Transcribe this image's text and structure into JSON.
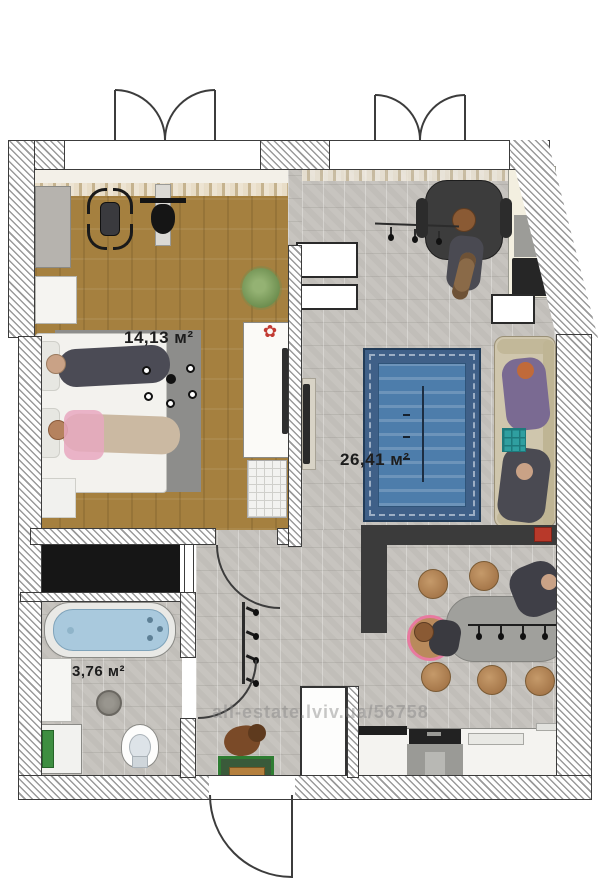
{
  "plan": {
    "type": "apartment-floor-plan",
    "labels": {
      "bedroom_area": "14,13 м²",
      "living_area": "26,41 м²",
      "bathroom_area": "3,76 м²"
    },
    "watermark": "all-estate.lviv.ua/56758",
    "rooms": [
      {
        "name": "bedroom-gym",
        "area": "14,13 м²",
        "floor": "wood"
      },
      {
        "name": "living-kitchen",
        "area": "26,41 м²",
        "floor": "stone"
      },
      {
        "name": "bathroom",
        "area": "3,76 м²",
        "floor": "stone"
      }
    ],
    "colors": {
      "wood_floor": "#a5803f",
      "stone_floor": "#c7c4bf",
      "rug_blue": "#4d7dab",
      "rug_border": "#3f6088",
      "sofa": "#cfc6ad",
      "bar_counter": "#3b3b3b",
      "stool": "#b98a5c",
      "dining_table": "#a0a09c",
      "bathtub": "#a9c9dd",
      "coffee_table": "#2f9fa0",
      "dog_stand_green": "#2e7d32",
      "wardrobe_black": "#161616",
      "accent_red": "#b8392a"
    },
    "icons": [
      "french-balcony-door-icon",
      "entrance-door-arc-icon",
      "interior-door-arc-icon",
      "bed-icon",
      "bathtub-icon",
      "toilet-icon",
      "washing-machine-icon",
      "sofa-icon",
      "dining-table-icon",
      "stool-icon",
      "bar-counter-icon",
      "kitchen-counter-icon",
      "desk-icon",
      "office-chair-icon",
      "exercise-bike-icon",
      "treadmill-icon",
      "plant-icon",
      "tv-icon",
      "chandelier-icon",
      "pendant-lights-icon",
      "coat-rack-icon",
      "dog-figure-icon",
      "floor-drain-icon"
    ]
  }
}
